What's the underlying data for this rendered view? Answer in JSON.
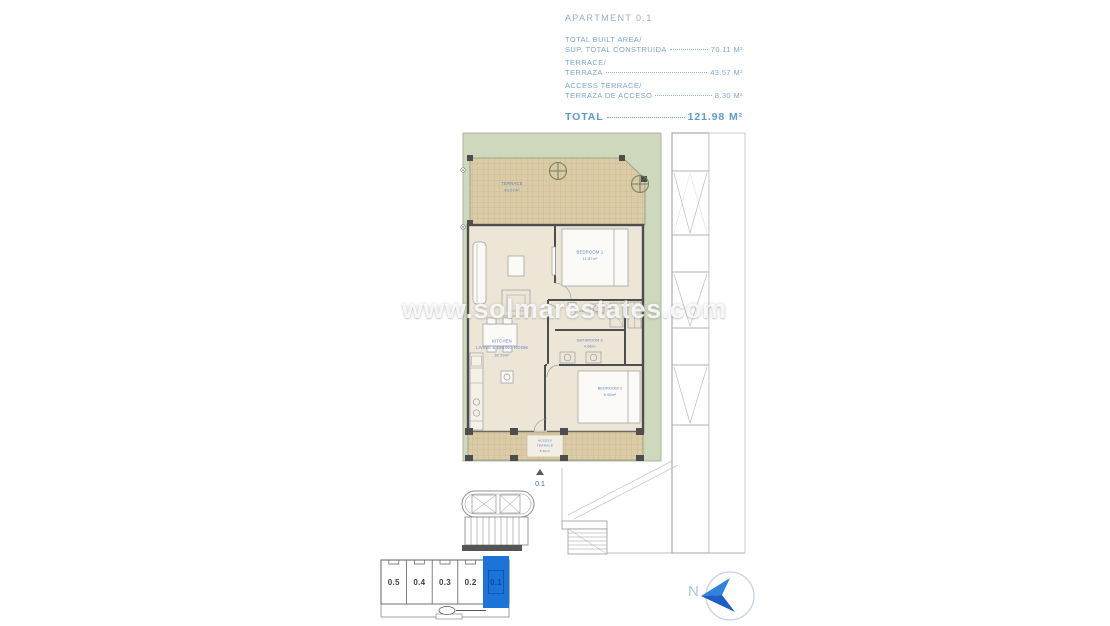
{
  "header": {
    "title": "APARTMENT 0.1",
    "rows": [
      {
        "line1": "TOTAL BUILT AREA/",
        "line2": "SUP. TOTAL CONSTRUIDA",
        "value": "70.11 M²"
      },
      {
        "line1": "TERRACE/",
        "line2": "TERRAZA",
        "value": "43.57 M²"
      },
      {
        "line1": "ACCESS TERRACE/",
        "line2": "TERRAZA DE ACCESO",
        "value": "8.30 M²"
      }
    ],
    "total": {
      "label": "TOTAL",
      "value": "121.98 M²"
    }
  },
  "plan": {
    "rooms": {
      "terrace": {
        "name": "TERRACE",
        "area": "43.57m²"
      },
      "bedroom1": {
        "name": "BEDROOM 1",
        "area": "11.87m²"
      },
      "kitchen": {
        "line1": "KITCHEN",
        "line2": "LIVING & DINING ROOM",
        "area": "30.29m²"
      },
      "bathroom1": {
        "name": "BATHROOM 1"
      },
      "bathroom2": {
        "name": "BATHROOM 2",
        "area": "4.66m²"
      },
      "bedroom2": {
        "name": "BEDROOM 2",
        "area": "9.00m²"
      },
      "access_terrace": {
        "line1": "ACCESS",
        "line2": "TERRACE",
        "area": "8.30m²"
      }
    },
    "unit_marker": "0.1"
  },
  "watermark": "www.solmarestates.com",
  "unit_selector": {
    "options": [
      "0.5",
      "0.4",
      "0.3",
      "0.2",
      "0.1"
    ],
    "selected": "0.1"
  },
  "compass": {
    "north_label": "N"
  },
  "colors": {
    "accent_blue": "#1b74d8",
    "label_blue": "#5b82c0",
    "header_blue": "#7fa7cc",
    "lot_green": "#cdd8bc",
    "terrace_tan": "#dbcba6"
  }
}
